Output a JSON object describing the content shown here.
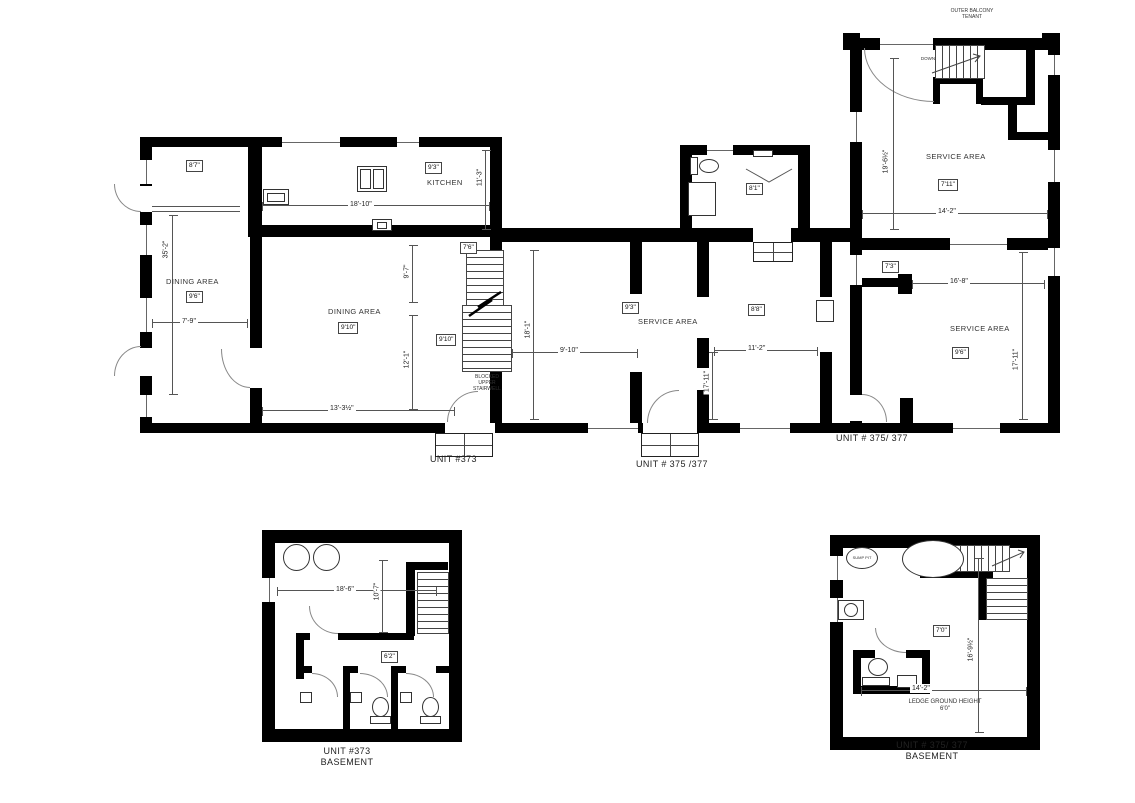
{
  "drawing": {
    "mf_left": {
      "unit_label": "UNIT #373",
      "room87_dim": "8'7\"",
      "dining1_name": "DINING AREA",
      "dining1_dim": "9'6\"",
      "kitchen_name": "KITCHEN",
      "kitchen_dim": "9'3\"",
      "dining2_name": "DINING AREA",
      "dining2_dim": "9'10\"",
      "stair_dim": "7'6\"",
      "stair_dim2": "9'10\"",
      "stair_note": "BLOCKED\nUPPER\nSTAIRWELL",
      "d_35_2": "35'-2\"",
      "d_7_9": "7'-9\"",
      "d_18_10": "18'-10\"",
      "d_11_3": "11'-3\"",
      "d_13_3h": "13'-3½\"",
      "d_9_7": "9'-7\"",
      "d_12_1": "12'-1\"",
      "d_18_1": "18'-1\""
    },
    "mf_mid": {
      "unit_label": "UNIT # 375 /377",
      "bath_dim": "8'1\"",
      "service_name": "SERVICE AREA",
      "service_dim": "9'3\"",
      "room88_dim": "8'8\"",
      "d_9_10": "9'-10\"",
      "d_17_11": "17'-11\"",
      "d_11_2": "11'-2\""
    },
    "mf_right": {
      "unit_label": "UNIT # 375/ 377",
      "balcony_note": "OUTER BALCONY\nTENANT",
      "down_label": "DOWN",
      "svc_top_name": "SERVICE AREA",
      "svc_top_dim": "7'11\"",
      "svc_bot_name": "SERVICE AREA",
      "svc_bot_dim": "9'6\"",
      "dim_7_3": "7'3\"",
      "d_19_6": "19'-6½\"",
      "d_14_2": "14'-2\"",
      "d_16_8": "16'-8\"",
      "d_17_11": "17'-11\""
    },
    "bsmt_left": {
      "unit_label": "UNIT #373\nBASEMENT",
      "d_18_6": "18'-6\"",
      "d_10_7": "10'-7\"",
      "dim_6_2": "6'2\""
    },
    "bsmt_right": {
      "unit_label": "UNIT # 375/ 377\nBASEMENT",
      "sump_label": "SUMP PIT",
      "ledge_note": "LEDGE GROUND HEIGHT\n6'0\"",
      "dim_7_0": "7'0\"",
      "d_16_9": "16'-9½\"",
      "d_14_2": "14'-2\""
    }
  }
}
